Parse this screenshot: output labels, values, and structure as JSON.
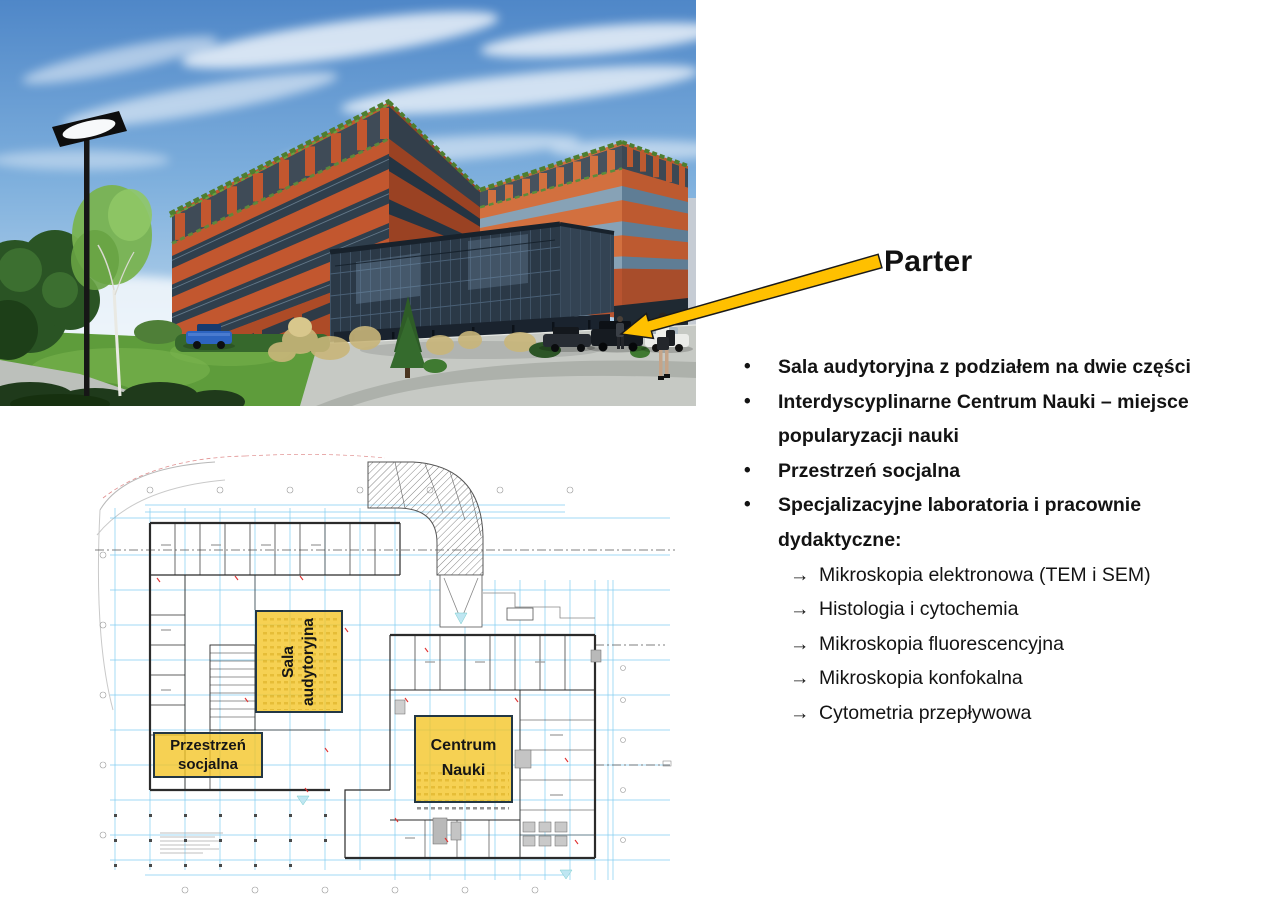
{
  "slide": {
    "title": "Parter",
    "bullet_glyphs": {
      "level1": "•",
      "level2": "→"
    },
    "bullets": [
      {
        "level": 1,
        "text": "Sala audytoryjna z podziałem na dwie części"
      },
      {
        "level": 1,
        "text": "Interdyscyplinarne Centrum Nauki – miejsce popularyzacji nauki"
      },
      {
        "level": 1,
        "text": "Przestrzeń socjalna"
      },
      {
        "level": 1,
        "text": "Specjalizacyjne laboratoria i pracownie dydaktyczne:"
      },
      {
        "level": 2,
        "text": "Mikroskopia elektronowa (TEM i SEM)"
      },
      {
        "level": 2,
        "text": "Histologia i cytochemia"
      },
      {
        "level": 2,
        "text": "Mikroskopia fluorescencyjna"
      },
      {
        "level": 2,
        "text": "Mikroskopia konfokalna"
      },
      {
        "level": 2,
        "text": "Cytometria przepływowa"
      }
    ]
  },
  "floor_plan": {
    "labels": {
      "auditorium": "Sala audytoryjna",
      "social": "Przestrzeń socjalna",
      "science": "Centrum Nauki"
    }
  },
  "colors": {
    "arrow_yellow": "#FFC000",
    "highlight_fill": "#F3C423",
    "highlight_border": "#233744",
    "plan_line_blue": "#6CC4EE",
    "building_orange": "#C2572F",
    "sky_blue": "#5A90CC",
    "grass_green": "#639F3E",
    "text_color": "#131313"
  }
}
